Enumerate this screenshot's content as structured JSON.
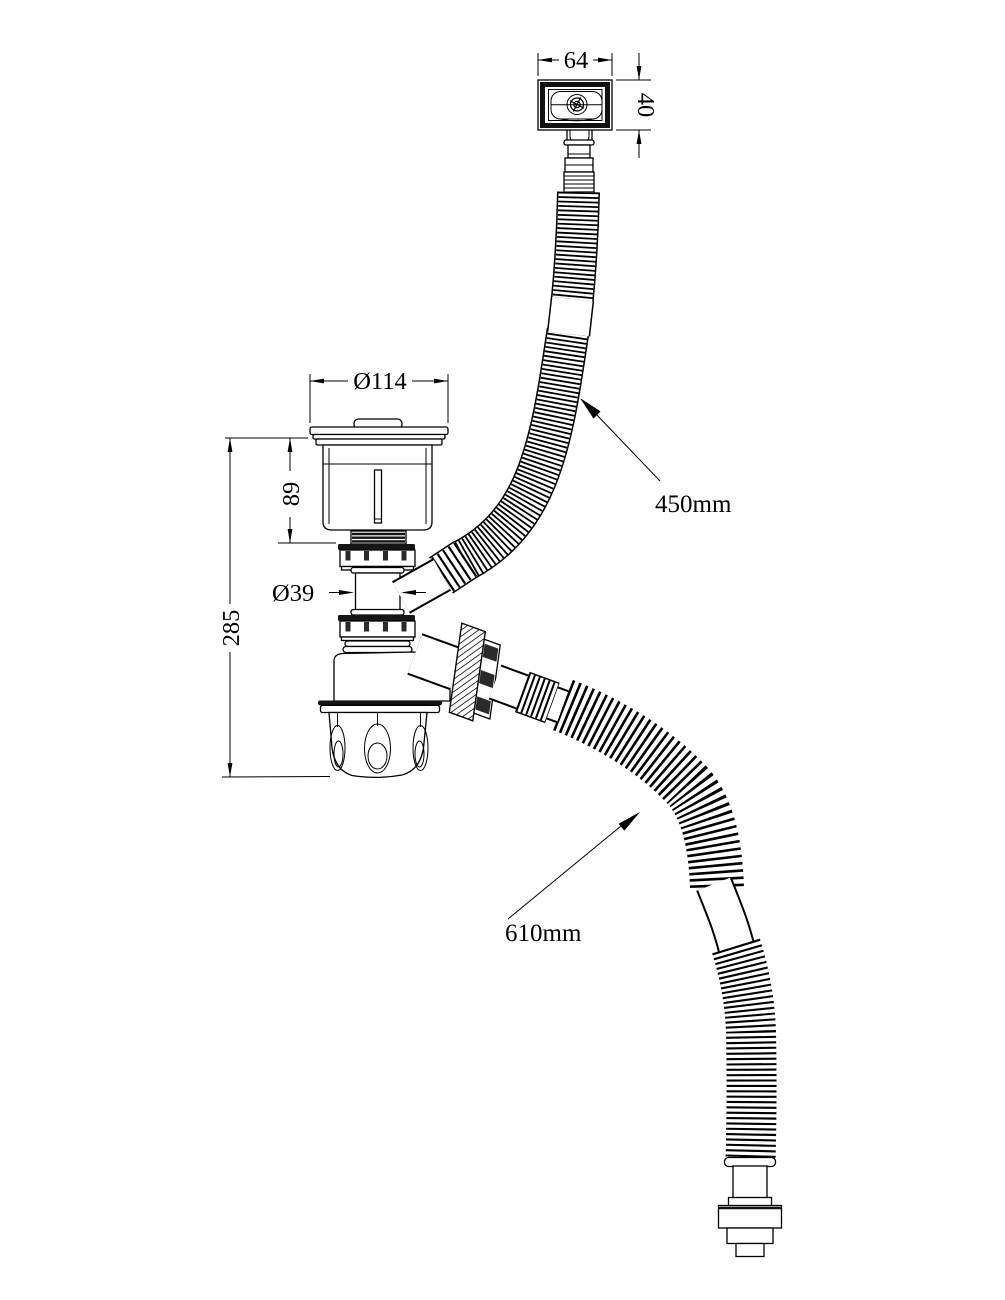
{
  "dimensions": {
    "overflow_width": "64",
    "overflow_height": "40",
    "strainer_diameter": "Ø114",
    "strainer_height": "89",
    "pipe_diameter": "Ø39",
    "overall_height": "285",
    "overflow_hose_length": "450mm",
    "drain_hose_length": "610mm"
  },
  "colors": {
    "line": "#000000",
    "background": "#ffffff",
    "dark_fill": "#161616"
  }
}
